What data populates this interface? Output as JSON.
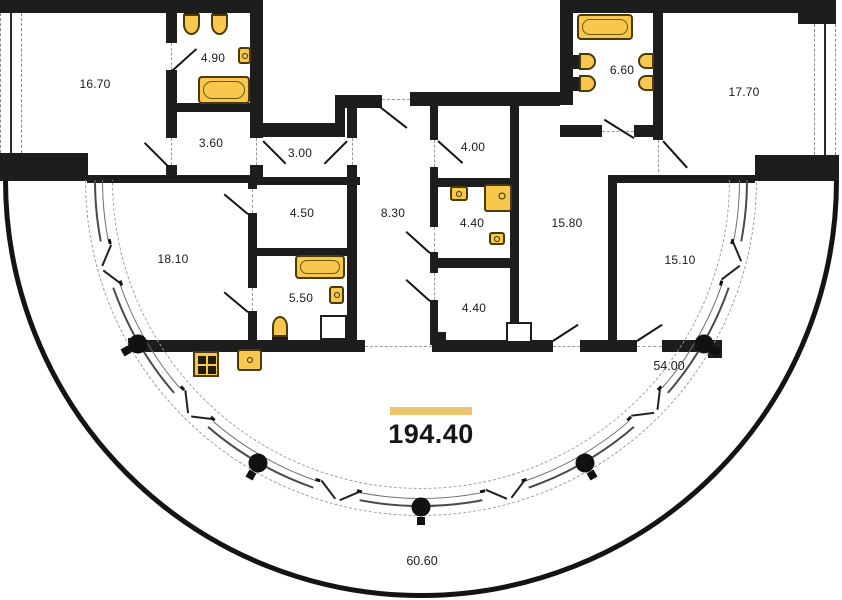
{
  "title": "Apartment floor plan",
  "rooms": {
    "r16_70": "16.70",
    "r4_90": "4.90",
    "r3_60": "3.60",
    "r3_00": "3.00",
    "r4_50": "4.50",
    "r5_50": "5.50",
    "r18_10": "18.10",
    "r8_30": "8.30",
    "r4_00": "4.00",
    "r4_40_top": "4.40",
    "r4_40_bottom": "4.40",
    "r15_80": "15.80",
    "r15_10": "15.10",
    "r6_60": "6.60",
    "r17_70": "17.70"
  },
  "terrace": {
    "glazed_area": "54.00",
    "open_balcony_area": "60.60",
    "total_area": "194.40"
  },
  "colors": {
    "wall": "#1d1d1d",
    "fixture_fill": "#F8C74E",
    "fixture_border": "#4a3a05",
    "accent_bar": "#ECC36E"
  }
}
